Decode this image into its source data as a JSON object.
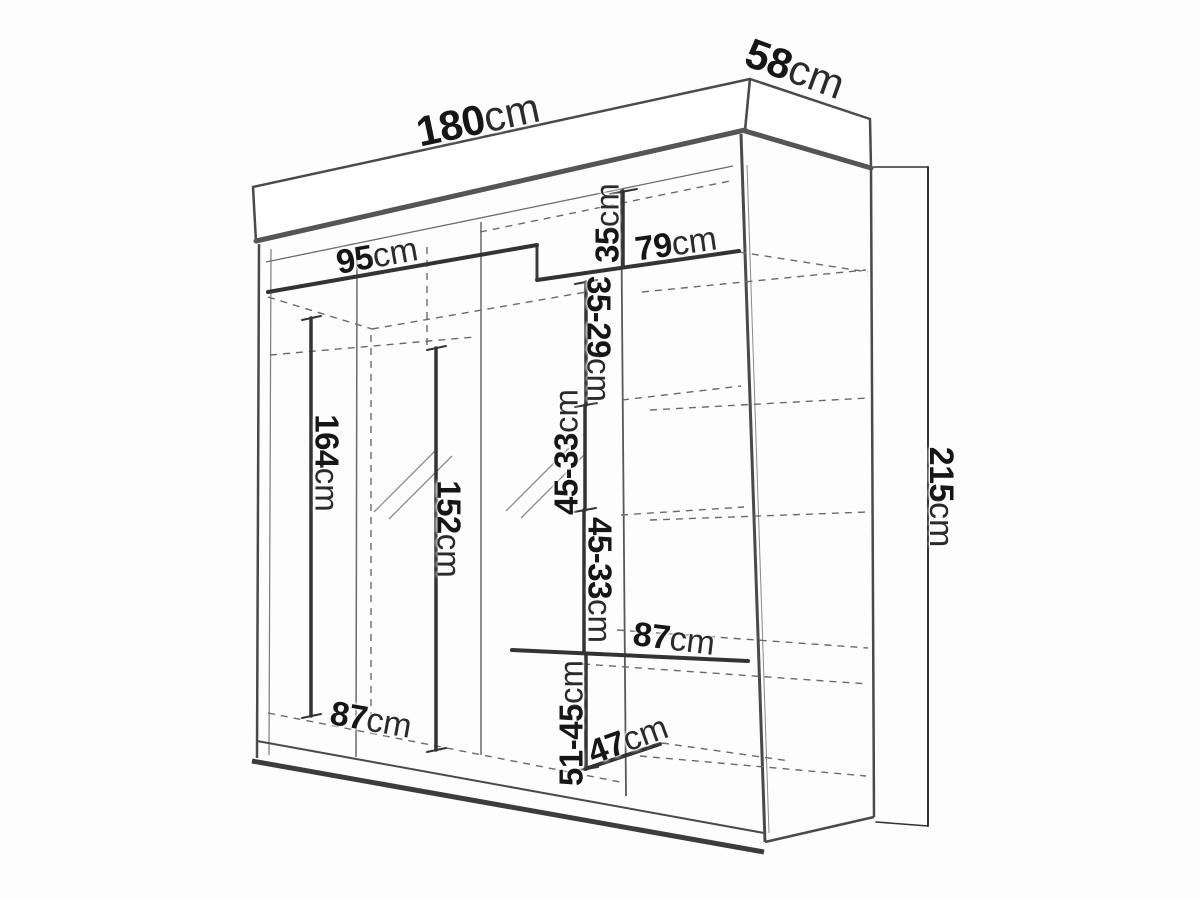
{
  "diagram": {
    "subject": "Sliding-door wardrobe technical dimension drawing",
    "unit_system": "cm"
  },
  "dims": {
    "width": {
      "value": "180",
      "unit": "cm"
    },
    "depth": {
      "value": "58",
      "unit": "cm"
    },
    "height": {
      "value": "215",
      "unit": "cm"
    },
    "rod_width": {
      "value": "95",
      "unit": "cm"
    },
    "top_shelf_width": {
      "value": "79",
      "unit": "cm"
    },
    "top_gap": {
      "value": "35",
      "unit": "cm"
    },
    "gap_second": {
      "value": "35-29",
      "unit": "cm"
    },
    "gap_third": {
      "value": "45-33",
      "unit": "cm"
    },
    "gap_fourth": {
      "value": "45-33",
      "unit": "cm"
    },
    "bottom_gap": {
      "value": "51-45",
      "unit": "cm"
    },
    "left_inner_height": {
      "value": "164",
      "unit": "cm"
    },
    "mid_inner_height": {
      "value": "152",
      "unit": "cm"
    },
    "mid_shelf_width": {
      "value": "87",
      "unit": "cm"
    },
    "bottom_width": {
      "value": "87",
      "unit": "cm"
    },
    "bottom_shelf_depth": {
      "value": "47",
      "unit": "cm"
    }
  }
}
